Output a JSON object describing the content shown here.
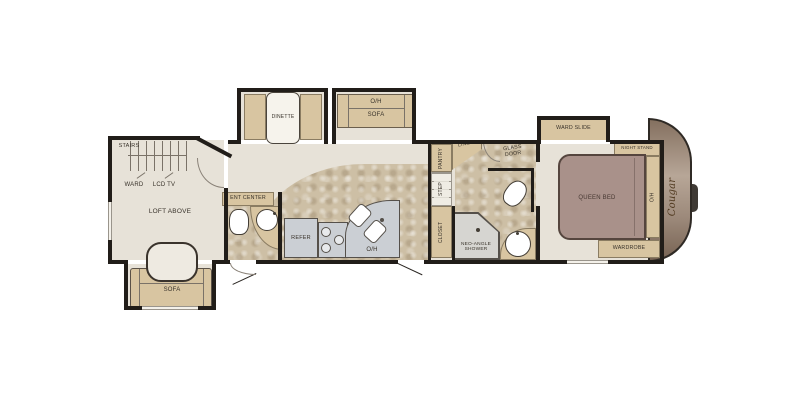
{
  "floorplan": {
    "brand_logo": "Cougar",
    "rear_living": {
      "stairs": "STAIRS",
      "ward": "WARD",
      "lcd_tv": "LCD TV",
      "loft": "LOFT ABOVE",
      "sofa": "SOFA"
    },
    "top_slides": {
      "dinette": "DINETTE",
      "sofa_oh": "O/H",
      "sofa": "SOFA",
      "ward_slide": "WARD SLIDE"
    },
    "galley": {
      "ent_center": "ENT CENTER",
      "refer": "REFER",
      "overhead": "O/H"
    },
    "mid_hall_bath": {
      "pantry": "PANTRY",
      "linen": "LINEN",
      "glass_door": "GLASS DOOR",
      "step": "STEP",
      "closet": "CLOSET",
      "shower": "NEO-ANGLE SHOWER"
    },
    "bedroom": {
      "night_stand": "NIGHT STAND",
      "queen_bed": "QUEEN BED",
      "overhead": "O/H",
      "wardrobe": "WARDROBE"
    },
    "colors": {
      "wall": "#211d19",
      "floor": "#e7e2d8",
      "tile": "#cdbfa5",
      "cabinet": "#d8c5a1",
      "appliance": "#cbcfd4",
      "bed": "#a9918a",
      "front_cap": "#9c897a",
      "hitch": "#3f3a35"
    }
  }
}
